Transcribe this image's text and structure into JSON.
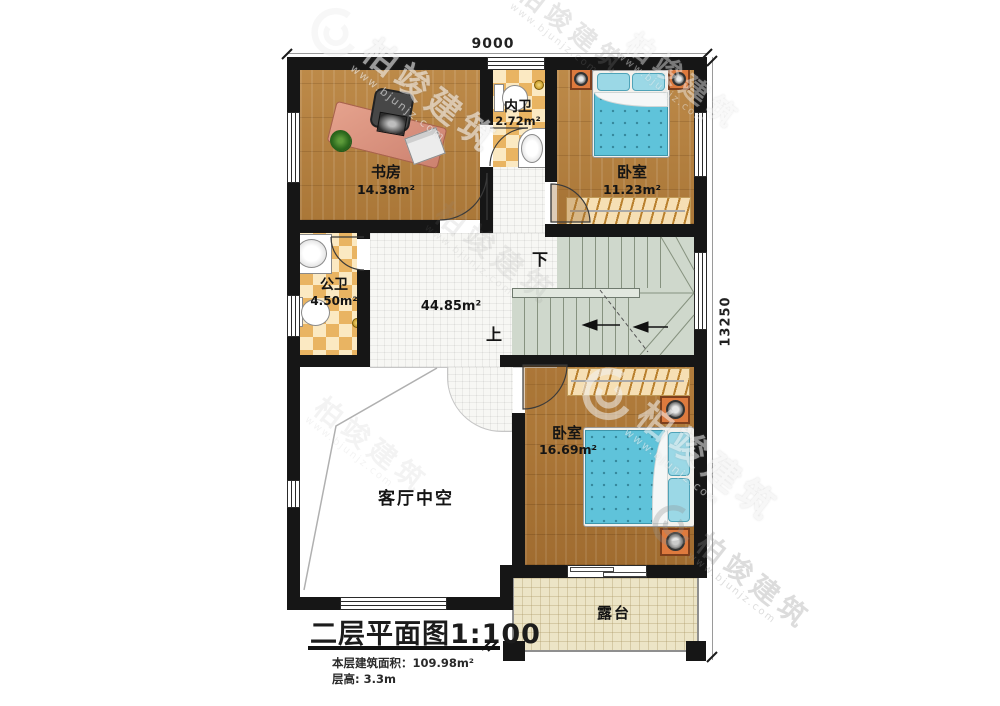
{
  "dimensions": {
    "width_top": "9000",
    "height_right": "13250"
  },
  "rooms": {
    "study": {
      "name": "书房",
      "area": "14.38m²"
    },
    "ensuite_bath": {
      "name": "内卫",
      "area": "2.72m²"
    },
    "bedroom1": {
      "name": "卧室",
      "area": "11.23m²"
    },
    "public_bath": {
      "name": "公卫",
      "area": "4.50m²"
    },
    "hall": {
      "area": "44.85m²"
    },
    "bedroom2": {
      "name": "卧室",
      "area": "16.69m²"
    },
    "living_void": {
      "name": "客厅中空"
    },
    "terrace": {
      "name": "露台"
    }
  },
  "stairs": {
    "down_label": "下",
    "up_label": "上"
  },
  "title_block": {
    "title": "二层平面图1:100",
    "area_text": "本层建筑面积：109.98m²",
    "floor_height_text": "层高: 3.3m"
  },
  "watermark": {
    "brand": "柏竣建筑",
    "url": "www.bjunjz.com"
  },
  "colors": {
    "wall": "#161616",
    "wood_floor": "#b5813f",
    "bath_tile": "#e9b462",
    "hall_tile": "#f7f7f4",
    "stair": "#cfd8cc",
    "bed_blanket": "#5fc3da",
    "terrace_floor": "#ece4c6",
    "nightstand": "#de7a3e"
  }
}
